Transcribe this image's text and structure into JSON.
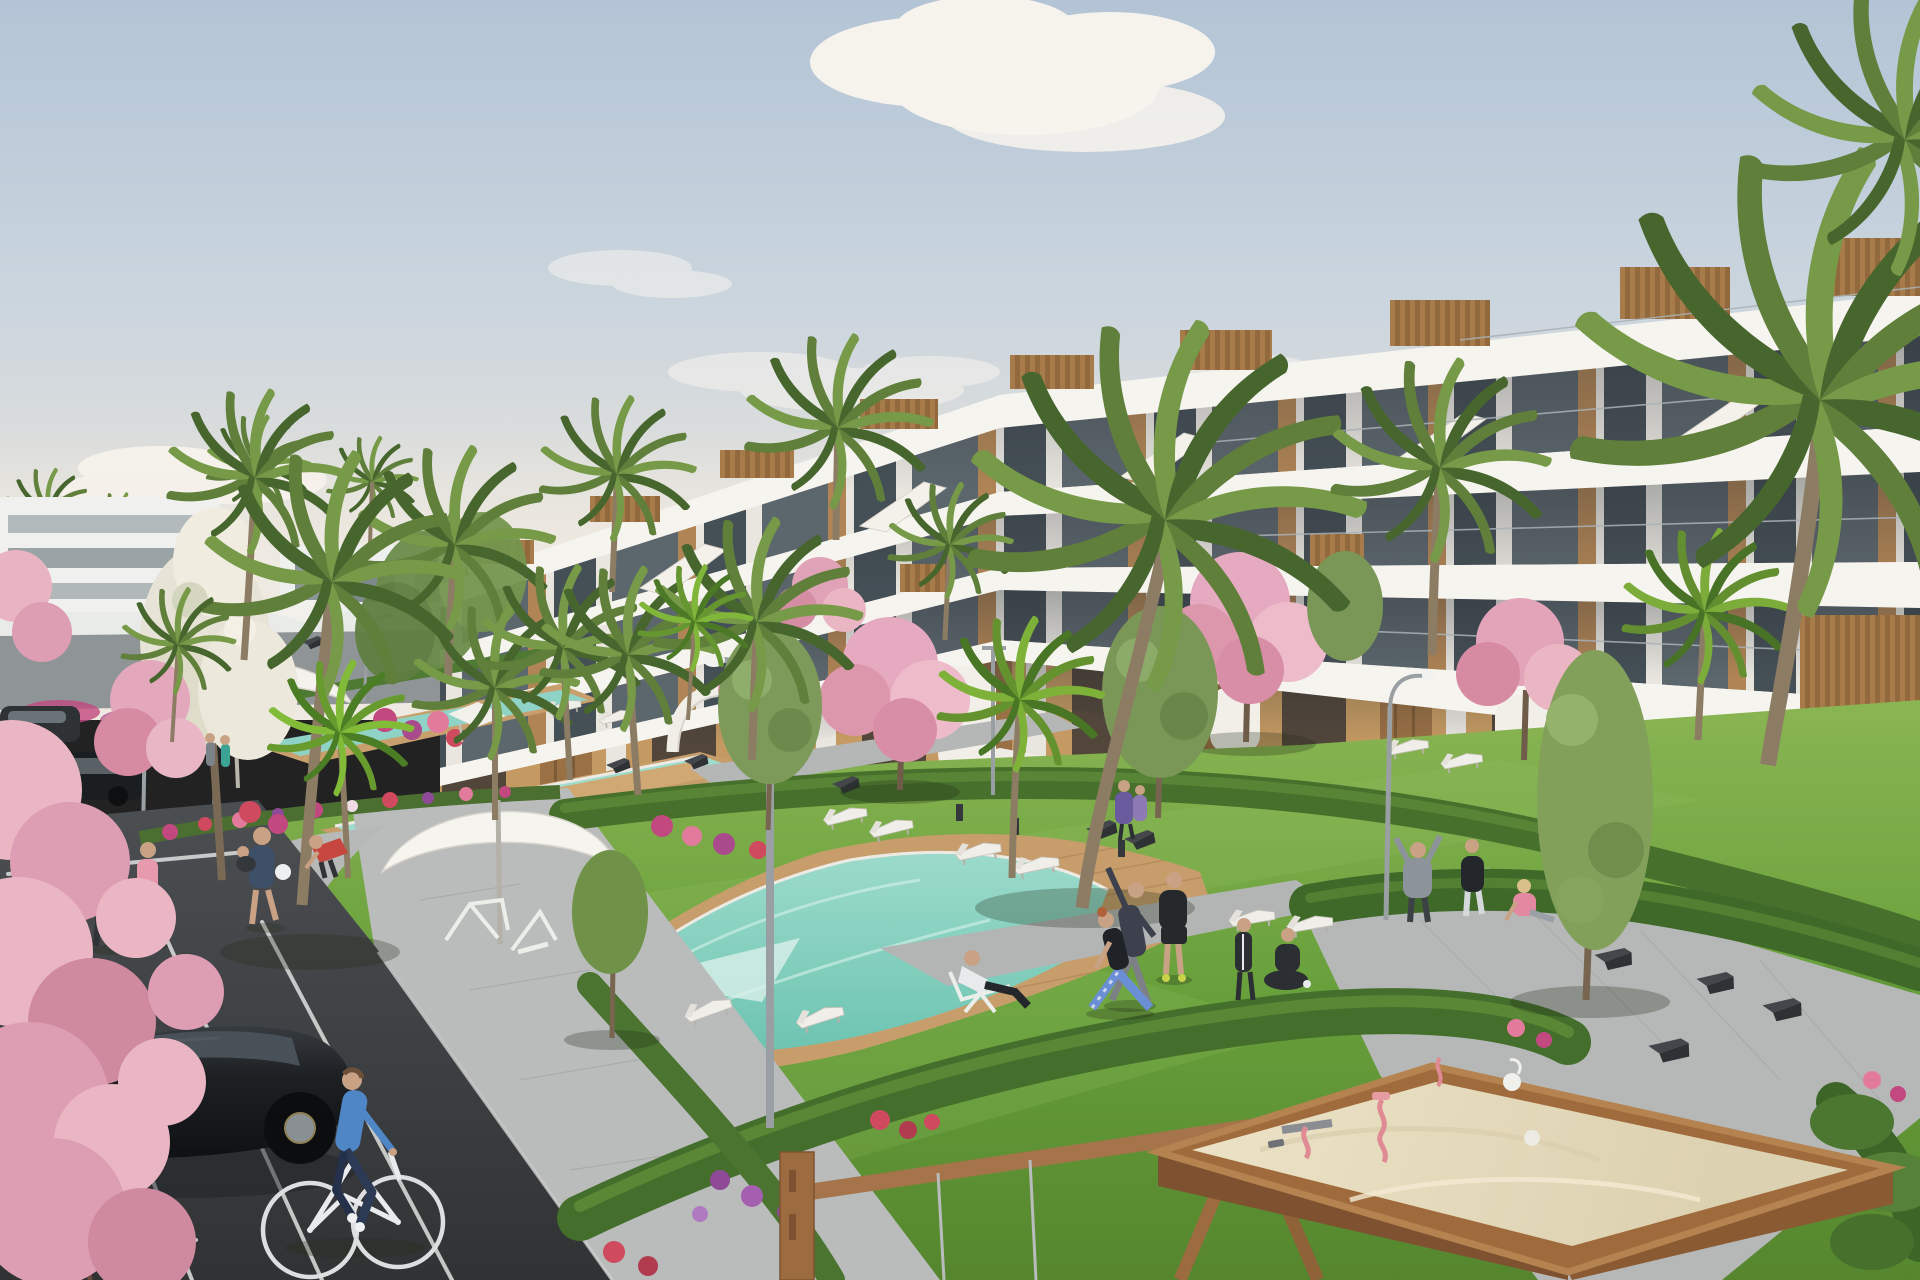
{
  "scene": {
    "setting": "residential-complex-architectural-render",
    "time_of_day": "daytime-clear-sky",
    "elements": [
      "sky",
      "clouds",
      "stepped-white-apartment-building",
      "rooftop-wood-boxes",
      "balcony-rows",
      "staircase-parapets",
      "ground-floor-terraces",
      "distant-white-buildings",
      "horizon-palms",
      "palm-trees",
      "cherry-blossom-trees",
      "white-blossom-tree",
      "olive-trees",
      "lawns",
      "hedges",
      "flower-beds",
      "upper-lap-pools",
      "main-pool",
      "wooden-pool-deck",
      "sun-loungers",
      "parasols",
      "shade-sails",
      "street-lamps",
      "garden-benches",
      "bollards",
      "walking-paths",
      "sidewalk",
      "parking-lot",
      "parking-lines",
      "black-hatchback-car",
      "distant-parked-cars",
      "cyclist",
      "joggers",
      "walker-with-ball",
      "yoga-exercise-group",
      "lounging-man",
      "families",
      "sitting-girl",
      "outdoor-gym-frames",
      "white-pergola-arch",
      "wooden-swing-frame",
      "playground-sandbox",
      "sand-toys",
      "foreground-cherry-blossoms"
    ],
    "counts": {
      "foreground_cars": 1,
      "distant_cars": 2,
      "cyclists": 1,
      "parasols": 2,
      "sandboxes": 1
    }
  },
  "palette": {
    "sky_top": "#b3c4d6",
    "sky_mid": "#ccd6de",
    "sky_low": "#e4e1da",
    "horizon": "#efeae1",
    "cloud_white": "#faf6ef",
    "building_white": "#efece6",
    "parapet_white": "#f6f4ef",
    "parapet_shadow": "#c9c5be",
    "glass_dark": "#454f56",
    "glass_mid": "#5c666d",
    "pier_white": "#e9e6e0",
    "wood_accent": "#b08455",
    "roofbox_wood": "#a87c4a",
    "roofbox_wood_dark": "#91693c",
    "ground_tan": "#c59a62",
    "opening_dark": "#52463b",
    "wood_dark": "#9a7045",
    "lawn_light": "#8ab553",
    "lawn_mid": "#68a03b",
    "lawn_dark": "#55862e",
    "hedge_green": "#46702c",
    "hedge_light": "#639339",
    "pool_light": "#9fdccd",
    "pool_deep": "#6cc3b0",
    "deck_wood": "#c79e6b",
    "path_grey": "#b9bcbb",
    "asphalt_top": "#4b4e51",
    "asphalt_bottom": "#303234",
    "line_white": "#dfe1df",
    "car_black": "#1d2023",
    "car_glass": "#495158",
    "sand_light": "#ece2c6",
    "sand_shadow": "#dcd1b0",
    "sandbox_wood": "#a06b3c",
    "sandbox_front": "#7e5230",
    "palm_green": "#5f7f3b",
    "palm_mid": "#769a47",
    "palm_deep": "#47662e",
    "trunk_brown": "#8d7c64",
    "blossom_light": "#eab6c4",
    "blossom_mid": "#dd9db2",
    "blossom_deep": "#d08aa0",
    "flower_magenta": "#c2497f",
    "flower_red": "#cf4a5e",
    "flower_purple": "#8e4a96",
    "white_furniture": "#f0eee8",
    "bench_dark": "#3b3e41",
    "lamp_grey": "#999fa2",
    "skin": "#c9a184",
    "shirt_blue": "#4f86c6",
    "pants_navy": "#2c3a55",
    "shirt_teal": "#3aa393",
    "shirt_pink": "#e79aae",
    "outfit_dark": "#2b2e33",
    "leggings_blue": "#6b8fd4",
    "shirt_red": "#c6473f",
    "hoodie_grey": "#8d939a",
    "shoes_yellow": "#c8d34a"
  }
}
